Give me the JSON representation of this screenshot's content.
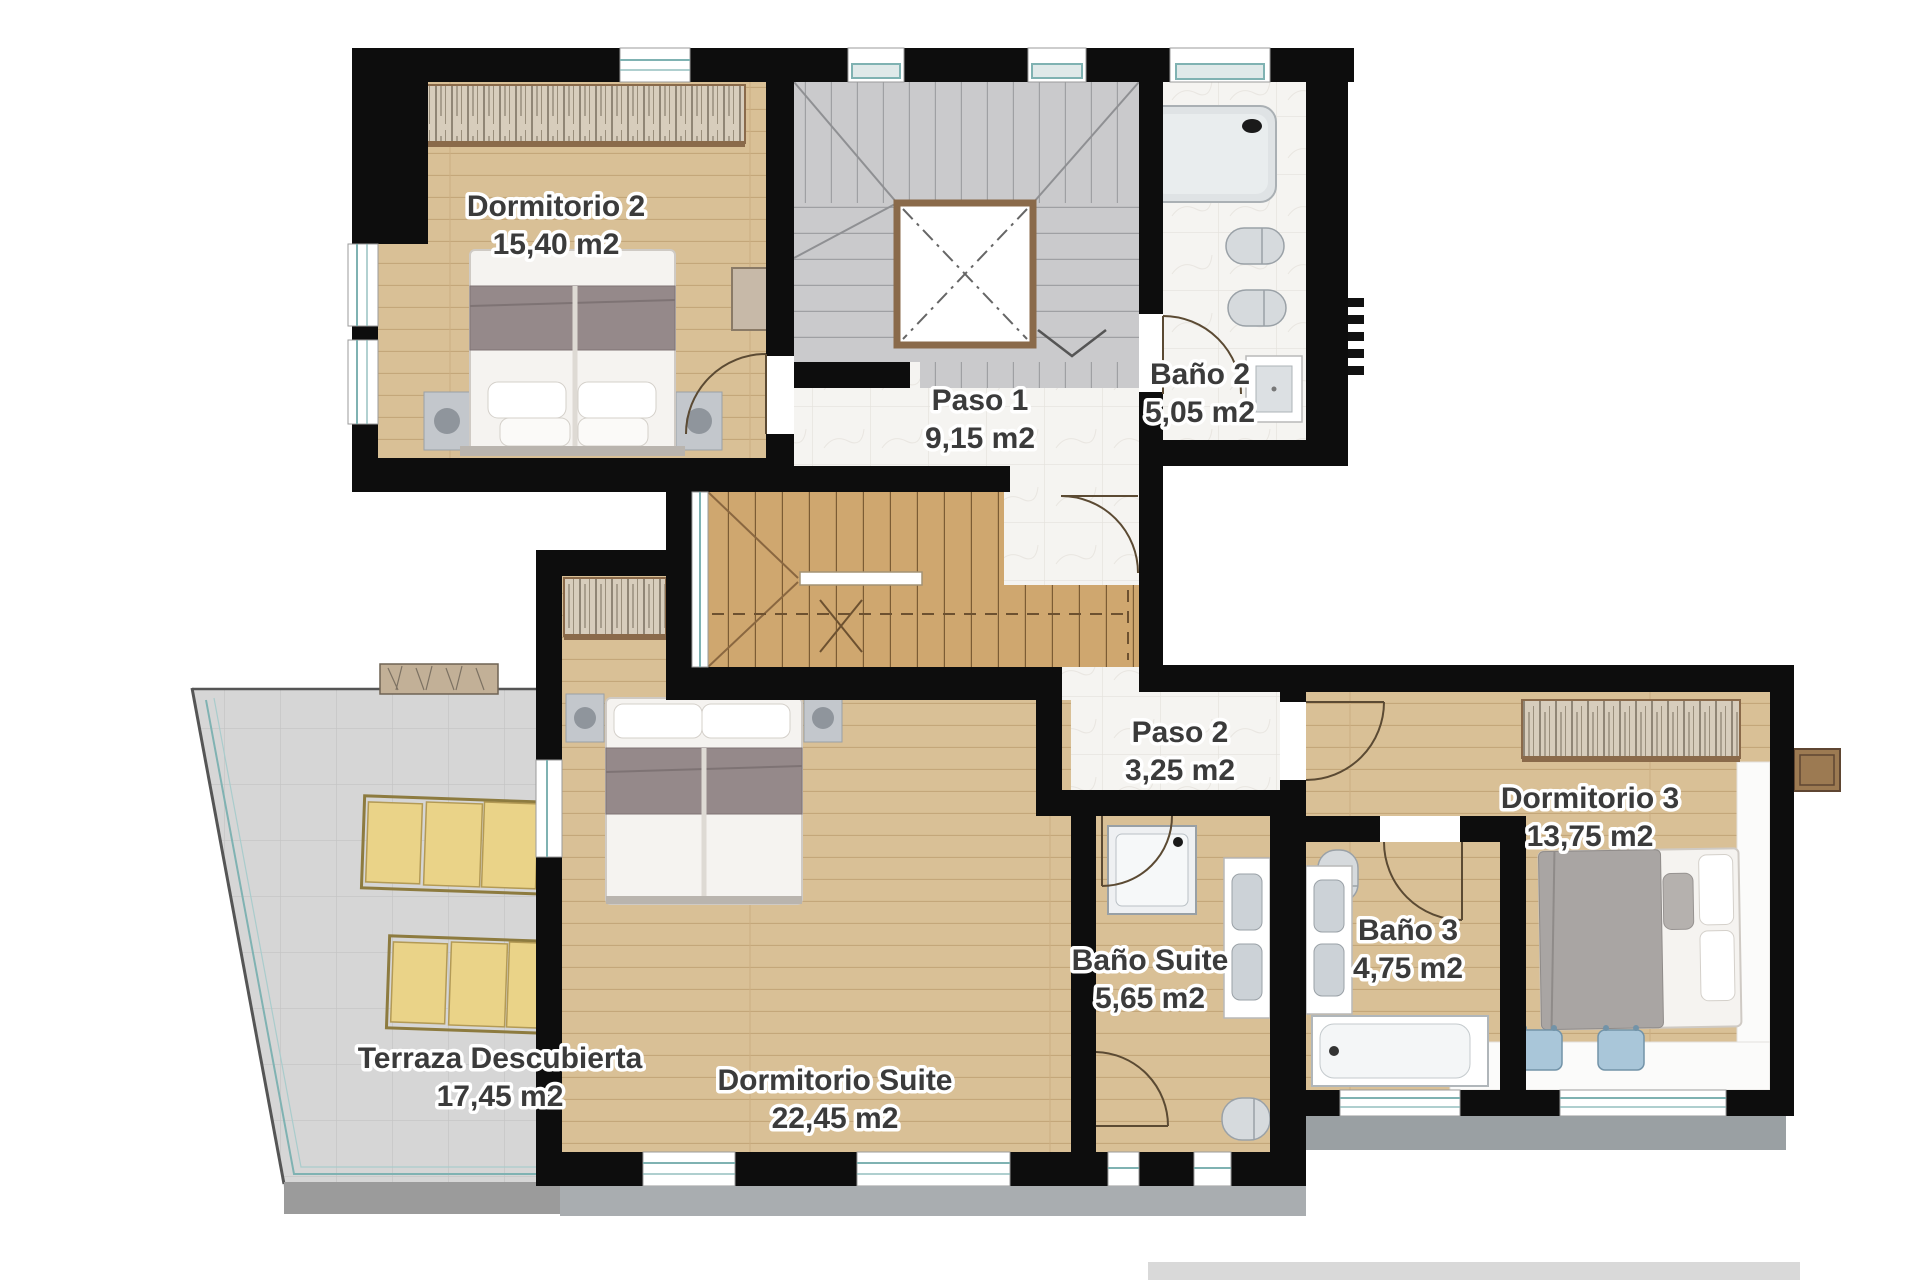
{
  "rooms": [
    {
      "name": "Dormitorio 2",
      "area": "15,40 m2"
    },
    {
      "name": "Paso 1",
      "area": "9,15 m2"
    },
    {
      "name": "Baño 2",
      "area": "5,05 m2"
    },
    {
      "name": "Paso 2",
      "area": "3,25 m2"
    },
    {
      "name": "Dormitorio 3",
      "area": "13,75 m2"
    },
    {
      "name": "Baño 3",
      "area": "4,75 m2"
    },
    {
      "name": "Baño Suite",
      "area": "5,65 m2"
    },
    {
      "name": "Dormitorio Suite",
      "area": "22,45 m2"
    },
    {
      "name": "Terraza Descubierta",
      "area": "17,45 m2"
    }
  ],
  "colors": {
    "wall": "#0d0d0d",
    "wood_floor": "#d9c096",
    "stair_wood": "#cfa76f",
    "marble": "#f5f4f1",
    "stair_tile": "#cacacc",
    "terrace_tile": "#d6d6d6",
    "accent_brown": "#8a6a4a",
    "window_teal": "#7fb2b2",
    "lounger_yellow": "#ead388",
    "label_text": "#3b3b3b"
  }
}
